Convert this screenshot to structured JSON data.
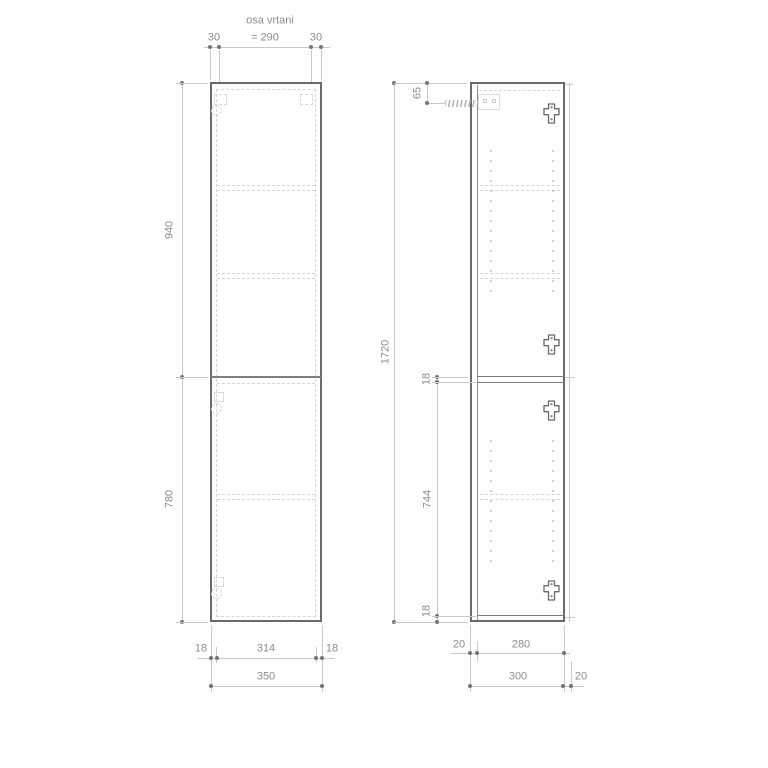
{
  "labels": {
    "drill_axis_title": "osa vrtani",
    "drill_axis_span": "= 290",
    "drill_offset_l": "30",
    "drill_offset_r": "30",
    "fv_upper_height": "940",
    "fv_lower_height": "780",
    "fv_bottom_left": "18",
    "fv_bottom_mid": "314",
    "fv_bottom_right": "18",
    "fv_bottom_total": "350",
    "sv_total_height": "1720",
    "sv_hanger_offset": "65",
    "sv_divider_thickness": "18",
    "sv_lower_inner": "744",
    "sv_bottom_thickness": "18",
    "sv_door_depth": "20",
    "sv_inner_depth": "280",
    "sv_total_depth": "300",
    "sv_back_gap": "20"
  },
  "colors": {
    "background": "#ffffff",
    "line_dark": "#6a6a6a",
    "line_mid": "#8f8f8f",
    "line_light": "#c9c9c9",
    "line_faint": "#d6d6d6",
    "text": "#8c8c8c",
    "dot": "#757575"
  },
  "geometry": {
    "shelf_y": [
      185,
      273,
      494
    ],
    "front_shelf": {
      "x": 217,
      "w": 98
    },
    "side_shelf": {
      "x": 480,
      "w": 80
    },
    "pin_columns": {
      "x": [
        490,
        552
      ],
      "ranges": [
        [
          150,
          290
        ],
        [
          440,
          560
        ]
      ],
      "step": 10
    },
    "cam_fittings": {
      "x": 543,
      "y": [
        103,
        334,
        400,
        580
      ]
    }
  }
}
